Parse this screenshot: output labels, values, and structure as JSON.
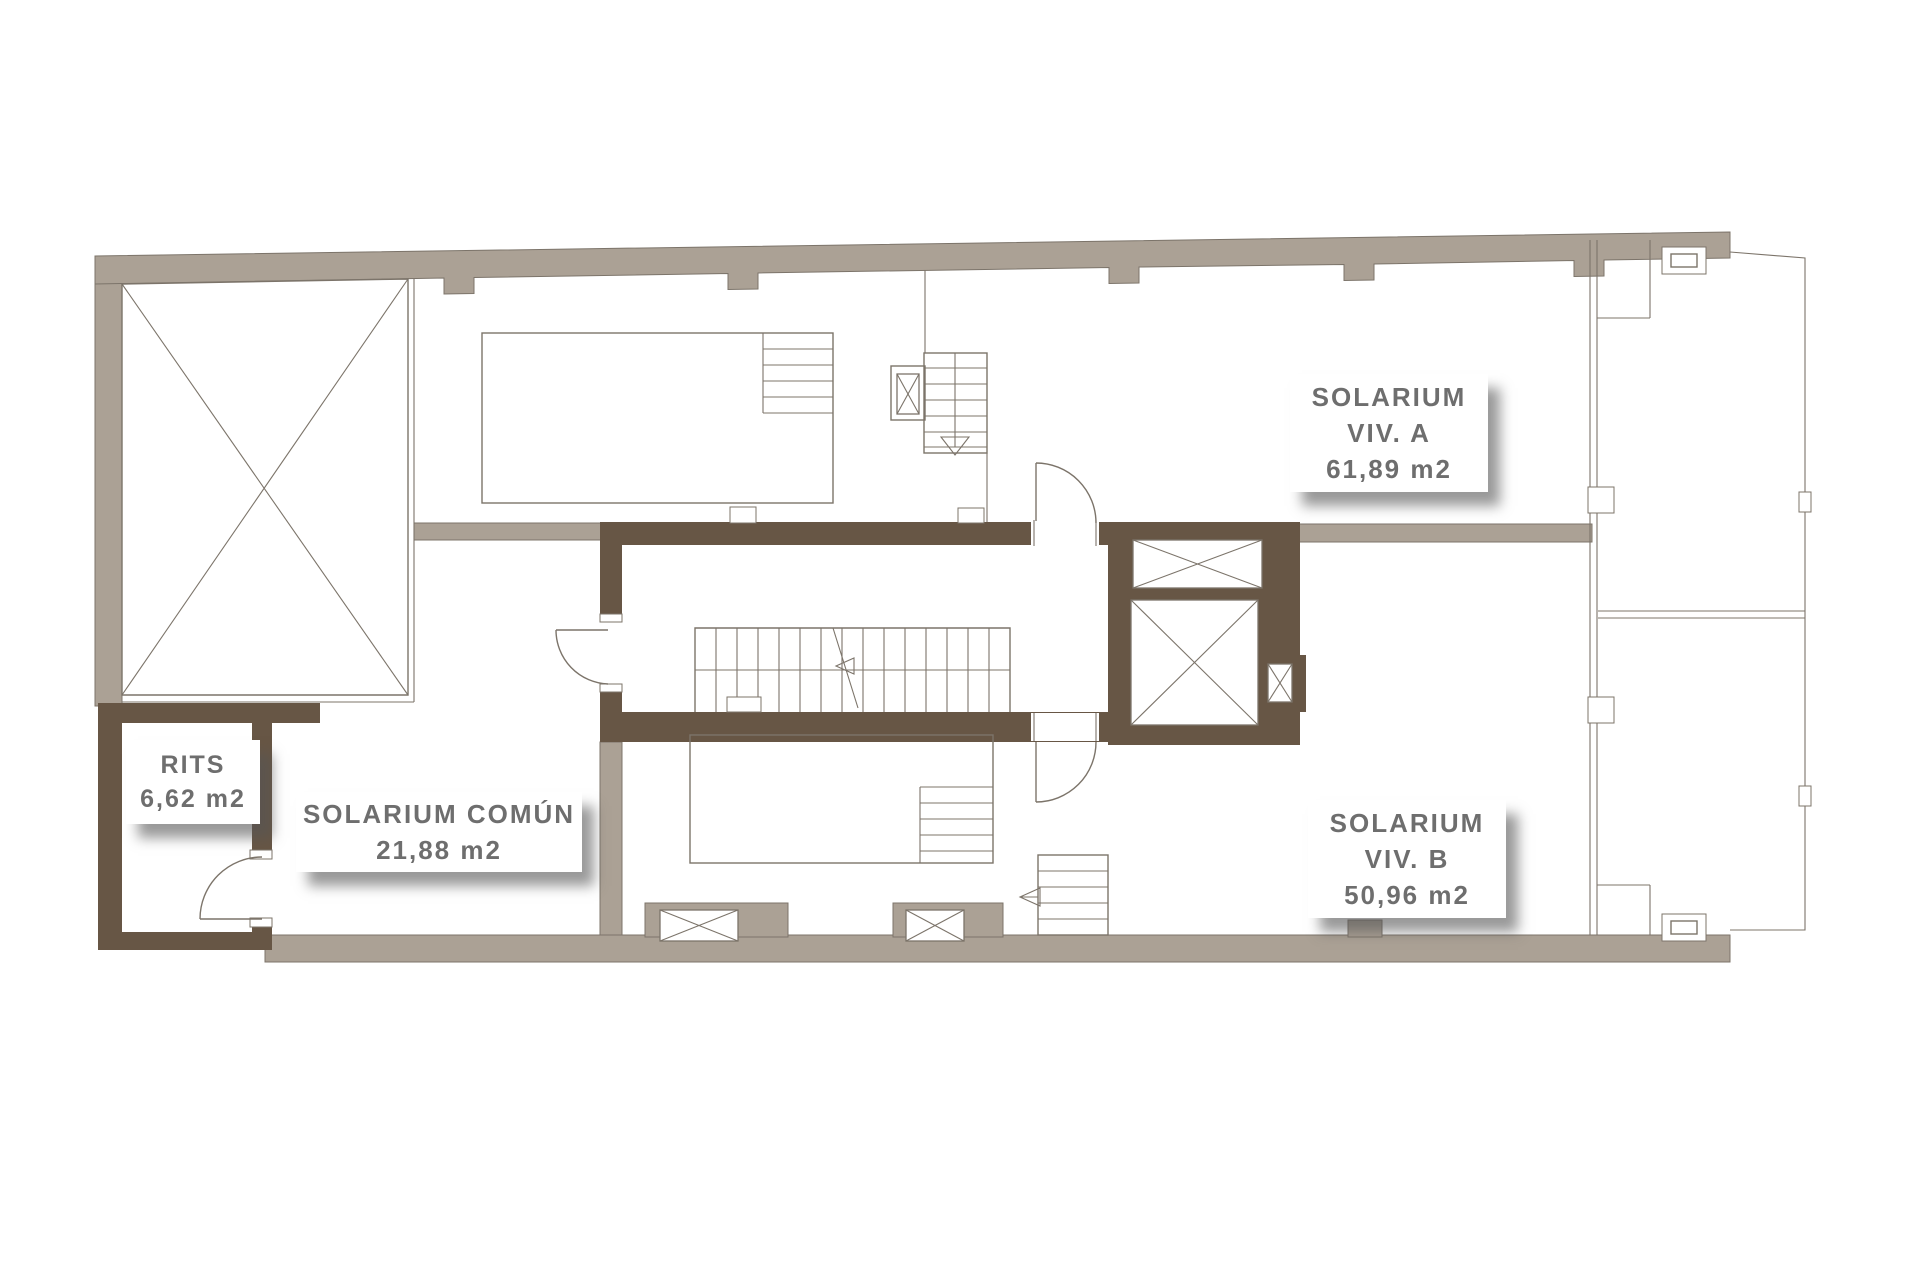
{
  "plan": {
    "title": "roof-solarium-floor-plan",
    "labels": {
      "solarium_a": {
        "line1": "SOLARIUM",
        "line2": "VIV. A",
        "area": "61,89 m2"
      },
      "solarium_b": {
        "line1": "SOLARIUM",
        "line2": "VIV. B",
        "area": "50,96 m2"
      },
      "solarium_comun": {
        "line1": "SOLARIUM COMÚN",
        "area": "21,88 m2"
      },
      "rits": {
        "line1": "RITS",
        "area": "6,62 m2"
      }
    },
    "colors": {
      "background": "#ffffff",
      "wall_gray": "#aba195",
      "wall_brown": "#675645",
      "line": "#7c746a",
      "label_text": "#6e6e6e"
    }
  }
}
